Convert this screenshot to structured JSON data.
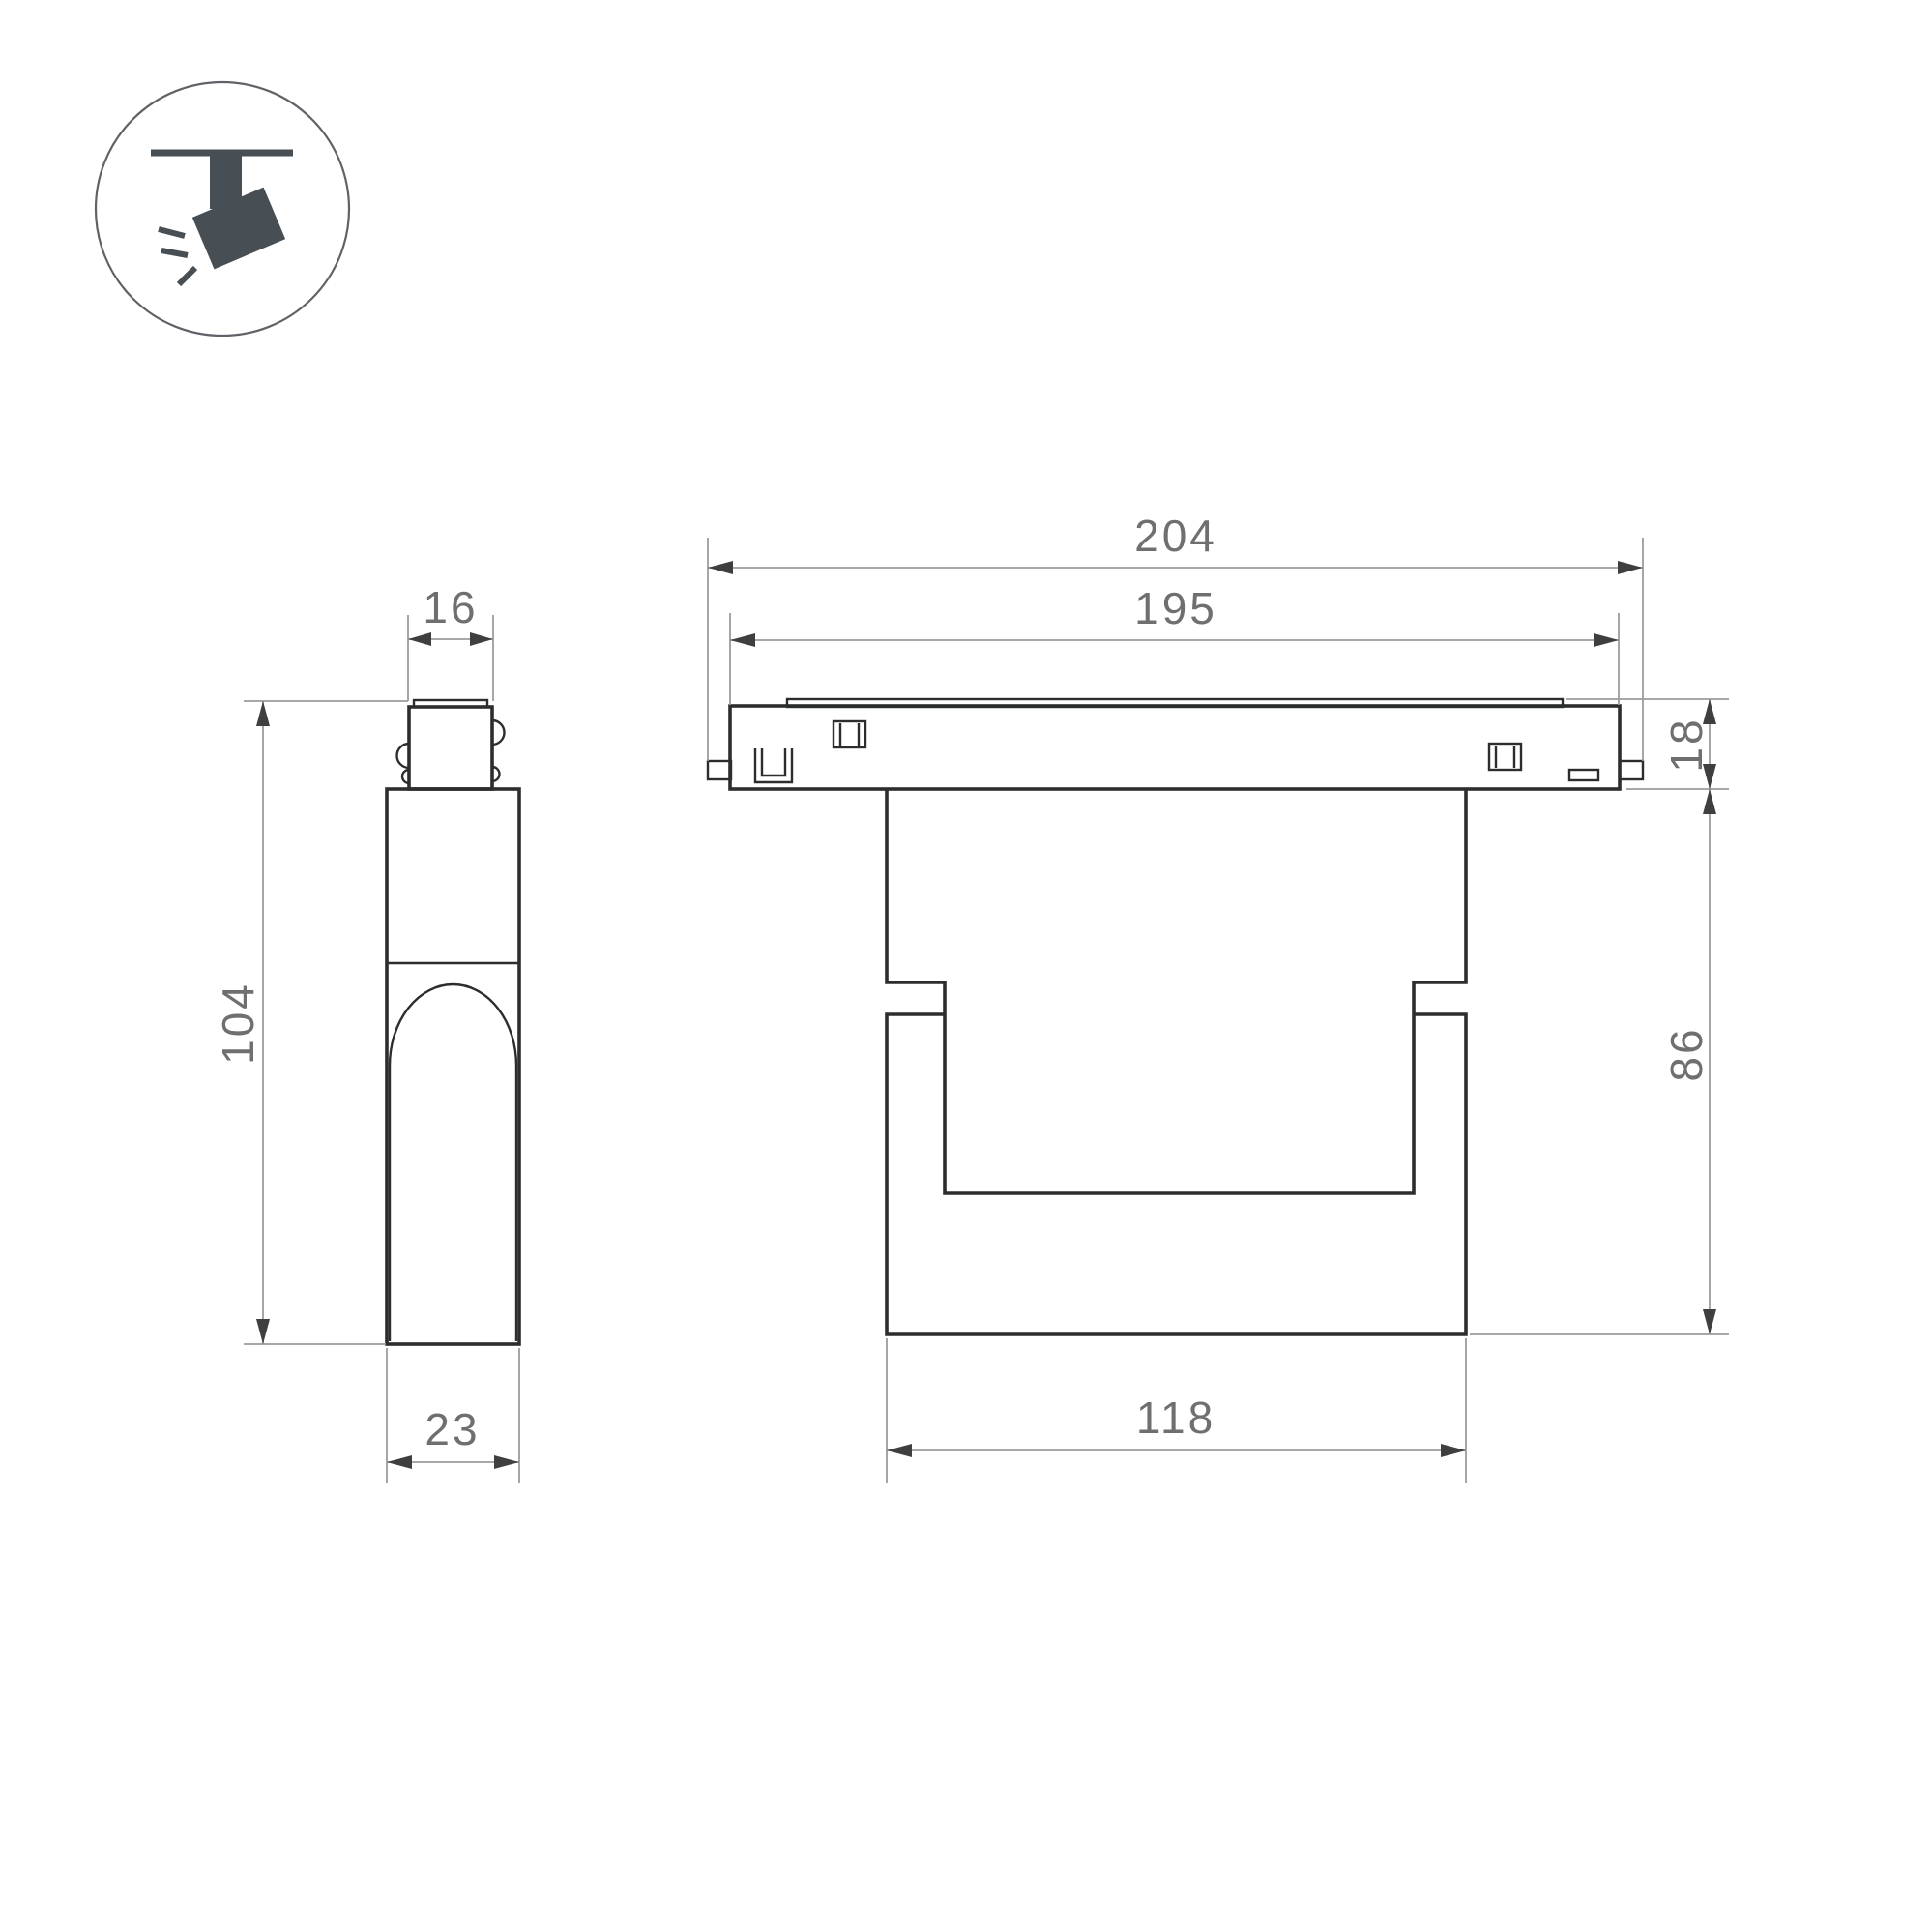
{
  "title": "Track luminaire dimension drawing",
  "canvas": {
    "background": "#ffffff",
    "outline_color": "#2b2d2e",
    "dim_line_color": "#9c9c9c",
    "arrow_color": "#3f3f3f",
    "dim_text_color": "#6f6f6f",
    "icon_color": "#474e54"
  },
  "icon": {
    "name": "ceiling-track-spotlight"
  },
  "side_view": {
    "adapter_width_mm": "16",
    "total_height_mm": "104",
    "body_depth_mm": "23"
  },
  "front_view": {
    "overall_length_mm": "204",
    "track_length_mm": "195",
    "track_height_mm": "18",
    "body_height_mm": "86",
    "body_width_mm": "118"
  }
}
